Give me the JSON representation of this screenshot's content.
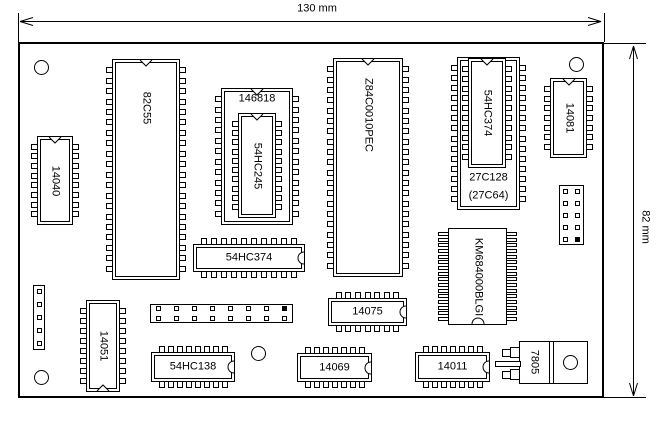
{
  "diagram": {
    "background": "#ffffff",
    "line_color": "#000000",
    "board": {
      "x": 18,
      "y": 42,
      "w": 586,
      "h": 356
    },
    "width_dim": {
      "label": "130 mm",
      "y": 21.5,
      "x1": 20,
      "x2": 601,
      "ext_top": 13,
      "label_x": 317,
      "label_y": 9
    },
    "height_dim": {
      "label": "82 mm",
      "x": 633.5,
      "y1": 46,
      "y2": 396,
      "ext_x2": 646,
      "label_x": 645,
      "label_y": 227
    },
    "holes": [
      {
        "cx": 41,
        "cy": 67,
        "d": 15
      },
      {
        "cx": 576,
        "cy": 64,
        "d": 15
      },
      {
        "cx": 41,
        "cy": 377,
        "d": 15
      },
      {
        "cx": 258,
        "cy": 353,
        "d": 15
      }
    ]
  },
  "components": [
    {
      "name": "chip-82c55",
      "kind": "dip-v",
      "label": "82C55",
      "x": 112,
      "y": 59,
      "w": 68,
      "h": 221,
      "pins": 20,
      "notch": "top",
      "label_rot": true,
      "label_cy": 0.22
    },
    {
      "name": "chip-14040",
      "kind": "dip-v",
      "label": "14040",
      "x": 37,
      "y": 136,
      "w": 36,
      "h": 89,
      "pins": 8,
      "notch": "top",
      "label_rot": true,
      "label_cy": 0.5
    },
    {
      "name": "socket-146818",
      "kind": "dip-v",
      "label": "146818",
      "x": 221,
      "y": 88,
      "w": 72,
      "h": 137,
      "pins": 12,
      "notch": "top",
      "label_rot": false,
      "label_cy": 0.08
    },
    {
      "name": "chip-54hc245",
      "kind": "dip-v",
      "label": "54HC245",
      "x": 238,
      "y": 113,
      "w": 38,
      "h": 105,
      "pins": 10,
      "notch": "top",
      "label_rot": true,
      "label_cy": 0.5
    },
    {
      "name": "chip-z84c0010pec",
      "kind": "dip-v",
      "label": "Z84C0010PEC",
      "x": 333,
      "y": 58,
      "w": 70,
      "h": 219,
      "pins": 20,
      "notch": "top",
      "label_rot": true,
      "label_cy": 0.26
    },
    {
      "name": "socket-27c128",
      "kind": "dip-v",
      "label": "27C128",
      "label2": "(27C64)",
      "x": 457,
      "y": 57,
      "w": 63,
      "h": 153,
      "pins": 14,
      "notch": "top",
      "label_rot": false,
      "label_cy": 0.79,
      "label2_cy": 0.91
    },
    {
      "name": "chip-54hc374-eprom-socket",
      "kind": "dip-v",
      "label": "54HC374",
      "x": 468,
      "y": 58,
      "w": 38,
      "h": 110,
      "pins": 10,
      "notch": "top",
      "label_rot": true,
      "label_cy": 0.5
    },
    {
      "name": "chip-14081",
      "kind": "dip-v",
      "label": "14081",
      "x": 550,
      "y": 78,
      "w": 37,
      "h": 80,
      "pins": 7,
      "notch": "top",
      "label_rot": true,
      "label_cy": 0.5
    },
    {
      "name": "chip-54hc374",
      "kind": "dip-h",
      "label": "54HC374",
      "x": 193,
      "y": 244,
      "w": 112,
      "h": 28,
      "pins": 10,
      "notch": "right"
    },
    {
      "name": "chip-km684000blgi",
      "kind": "soj",
      "label": "KM684000BLGI",
      "x": 448,
      "y": 228,
      "w": 59,
      "h": 97,
      "pins": 16,
      "notch": "bottom-arc",
      "label_rot": true
    },
    {
      "name": "chip-14075",
      "kind": "dip-h",
      "label": "14075",
      "x": 328,
      "y": 298,
      "w": 79,
      "h": 28,
      "pins": 7,
      "notch": "right"
    },
    {
      "name": "chip-14051",
      "kind": "dip-v",
      "label": "14051",
      "x": 86,
      "y": 300,
      "w": 34,
      "h": 92,
      "pins": 8,
      "notch": "bottom",
      "label_rot": true,
      "label_cy": 0.5
    },
    {
      "name": "chip-54hc138",
      "kind": "dip-h",
      "label": "54HC138",
      "x": 151,
      "y": 352,
      "w": 84,
      "h": 30,
      "pins": 8,
      "notch": "right"
    },
    {
      "name": "chip-14069",
      "kind": "dip-h",
      "label": "14069",
      "x": 297,
      "y": 353,
      "w": 75,
      "h": 29,
      "pins": 7,
      "notch": "right"
    },
    {
      "name": "chip-14011",
      "kind": "dip-h",
      "label": "14011",
      "x": 415,
      "y": 352,
      "w": 75,
      "h": 30,
      "pins": 7,
      "notch": "right"
    },
    {
      "name": "regulator-7805",
      "kind": "to220",
      "label": "7805",
      "body": {
        "x": 519,
        "y": 341,
        "w": 69,
        "h": 43
      },
      "dividers": [
        549,
        553
      ],
      "label_cx": 534,
      "label_cy": 362,
      "hole": {
        "cx": 570,
        "cy": 362,
        "d": 15
      },
      "leads": [
        [
          502,
          349,
          9,
          8
        ],
        [
          510,
          347,
          10,
          11
        ],
        [
          495,
          361,
          26,
          6
        ],
        [
          502,
          371,
          9,
          8
        ],
        [
          510,
          369,
          10,
          11
        ]
      ]
    },
    {
      "name": "pin-header-1x5",
      "kind": "header",
      "x": 33,
      "y": 285,
      "w": 12,
      "h": 65,
      "cols": 1,
      "rows": 5,
      "filled": []
    },
    {
      "name": "pin-header-2x8",
      "kind": "header",
      "x": 150,
      "y": 304,
      "w": 143,
      "h": 19,
      "cols": 8,
      "rows": 2,
      "filled": [
        [
          0,
          7
        ]
      ]
    },
    {
      "name": "pin-header-2x5",
      "kind": "header",
      "x": 559,
      "y": 185,
      "w": 25,
      "h": 60,
      "cols": 2,
      "rows": 5,
      "filled": [
        [
          4,
          1
        ]
      ]
    }
  ]
}
